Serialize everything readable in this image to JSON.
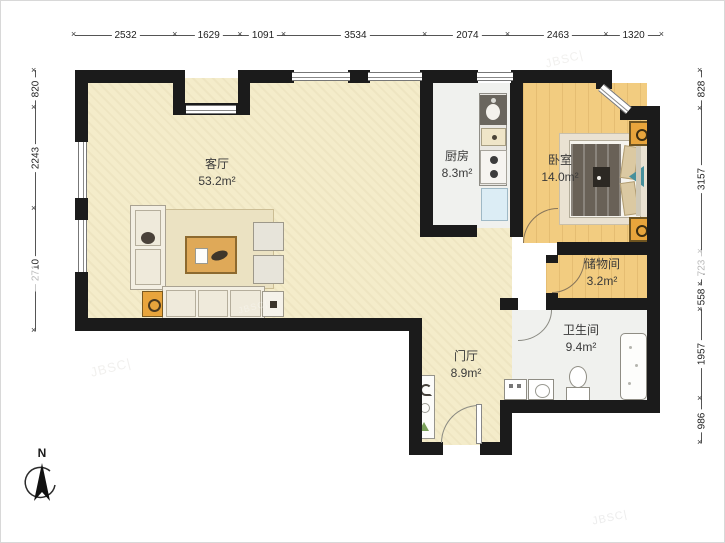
{
  "rooms": [
    {
      "name": "客厅",
      "area": "53.2m²"
    },
    {
      "name": "厨房",
      "area": "8.3m²"
    },
    {
      "name": "卧室",
      "area": "14.0m²"
    },
    {
      "name": "储物间",
      "area": "3.2m²"
    },
    {
      "name": "卫生间",
      "area": "9.4m²"
    },
    {
      "name": "门厅",
      "area": "8.9m²"
    }
  ],
  "dimensions": {
    "top": [
      "2532",
      "1629",
      "1091",
      "3534",
      "2074",
      "2463",
      "1320"
    ],
    "left": [
      "820",
      "2243",
      "2710"
    ],
    "right": [
      "828",
      "3157",
      "723",
      "558",
      "1957",
      "986"
    ]
  },
  "compass": {
    "label": "N"
  },
  "watermark": "JBSC|",
  "colors": {
    "wall": "#1b1b1b",
    "floor_living": "#f4ecca",
    "floor_wood": "#f2cc80",
    "floor_tile": "#f0f1ee",
    "accent_orange": "#e8a53c"
  }
}
